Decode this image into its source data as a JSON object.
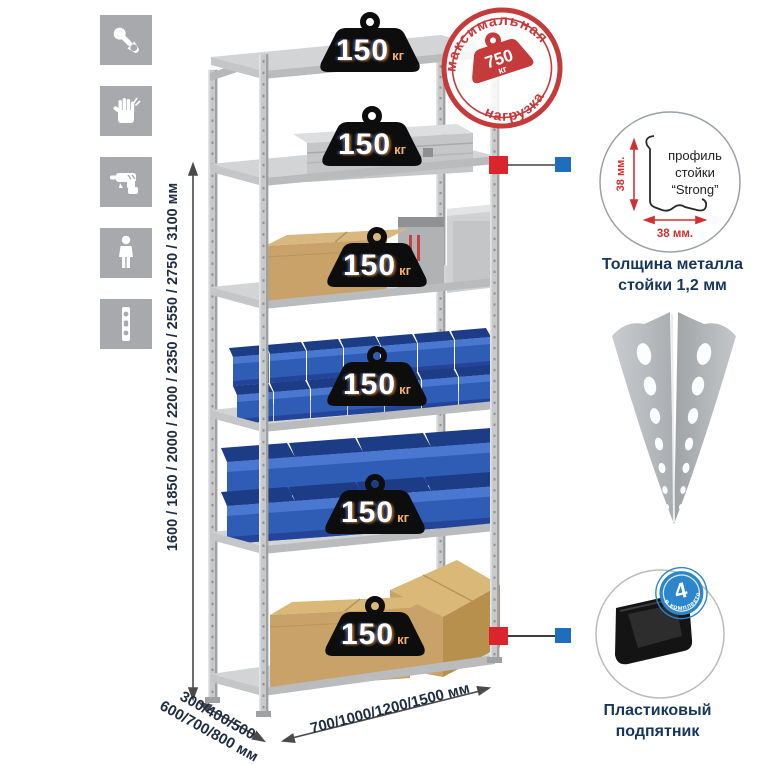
{
  "features": {
    "icons": [
      {
        "name": "wrench"
      },
      {
        "name": "gloves"
      },
      {
        "name": "drill"
      },
      {
        "name": "person"
      },
      {
        "name": "profile-strip"
      }
    ]
  },
  "dimensions": {
    "height": "1600 / 1850 / 2000 / 2200 / 2350 / 2550 / 2750 / 3100 мм",
    "depth_line1": "300/400/500",
    "depth_line2": "600/700/800 мм",
    "width": "700/1000/1200/1500 мм"
  },
  "rack": {
    "shelf_count": 6,
    "shelf_load": {
      "value": "150",
      "unit": "кг"
    }
  },
  "max_load_stamp": {
    "top_arc": "максимальная",
    "bottom_arc": "нагрузка",
    "value": "750",
    "unit": "кг"
  },
  "profile_detail": {
    "line1": "профиль",
    "line2": "стойки",
    "line3": "“Strong”",
    "dim_v": "38 мм.",
    "dim_h": "38 мм.",
    "caption1": "Толщина металла",
    "caption2": "стойки 1,2 мм"
  },
  "foot_detail": {
    "badge_value": "4",
    "badge_arc": "в комплекте",
    "caption1": "Пластиковый",
    "caption2": "подпятник"
  },
  "colors": {
    "accent_red": "#c9373a",
    "accent_blue": "#1d6fbe",
    "navy": "#16365c",
    "bin_blue": "#2f5cb4",
    "metal": "#c7c9cb",
    "badge_black": "#0d0d0d",
    "kg_orange": "#f0a35c"
  }
}
